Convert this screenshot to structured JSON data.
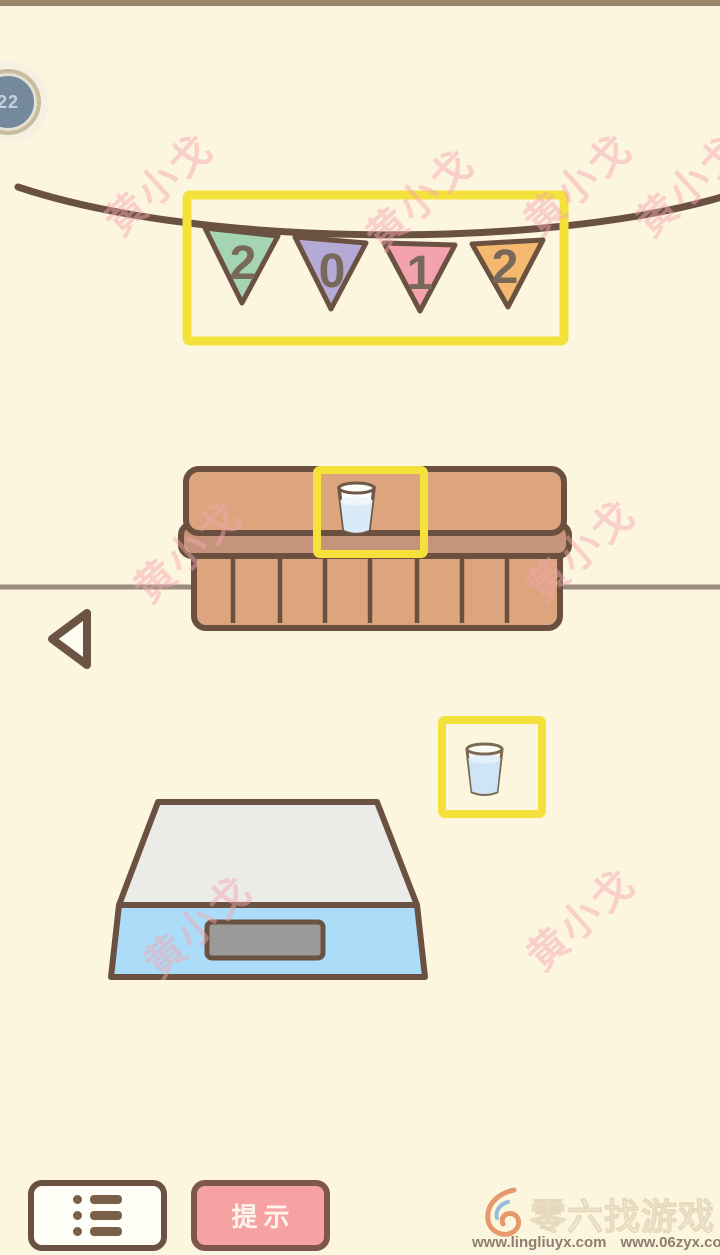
{
  "scene": {
    "background_color": "#fdf6de",
    "top_bar_color": "#9a8669",
    "highlight_color": "#f4e13c",
    "outline_color": "#6b5142",
    "floor_line_color": "#9c8c7e",
    "cabinet_color": "#dca57d",
    "scale_body_color": "#abdcf8"
  },
  "level_badge": {
    "value": "22"
  },
  "banner": {
    "flags": [
      {
        "digit": "2",
        "color": "#a5d4b2"
      },
      {
        "digit": "0",
        "color": "#b5a9d6"
      },
      {
        "digit": "1",
        "color": "#f4a2ad"
      },
      {
        "digit": "2",
        "color": "#f4b96e"
      }
    ]
  },
  "toolbar": {
    "menu_icon": "list-icon",
    "hint_label": "提示"
  },
  "watermark": {
    "text": "黄小戈",
    "color": "#f3a6b1"
  },
  "footer": {
    "site_name": "零六找游戏",
    "url_left": "www.lingliuyx.com",
    "url_right": "www.06zyx.com"
  }
}
